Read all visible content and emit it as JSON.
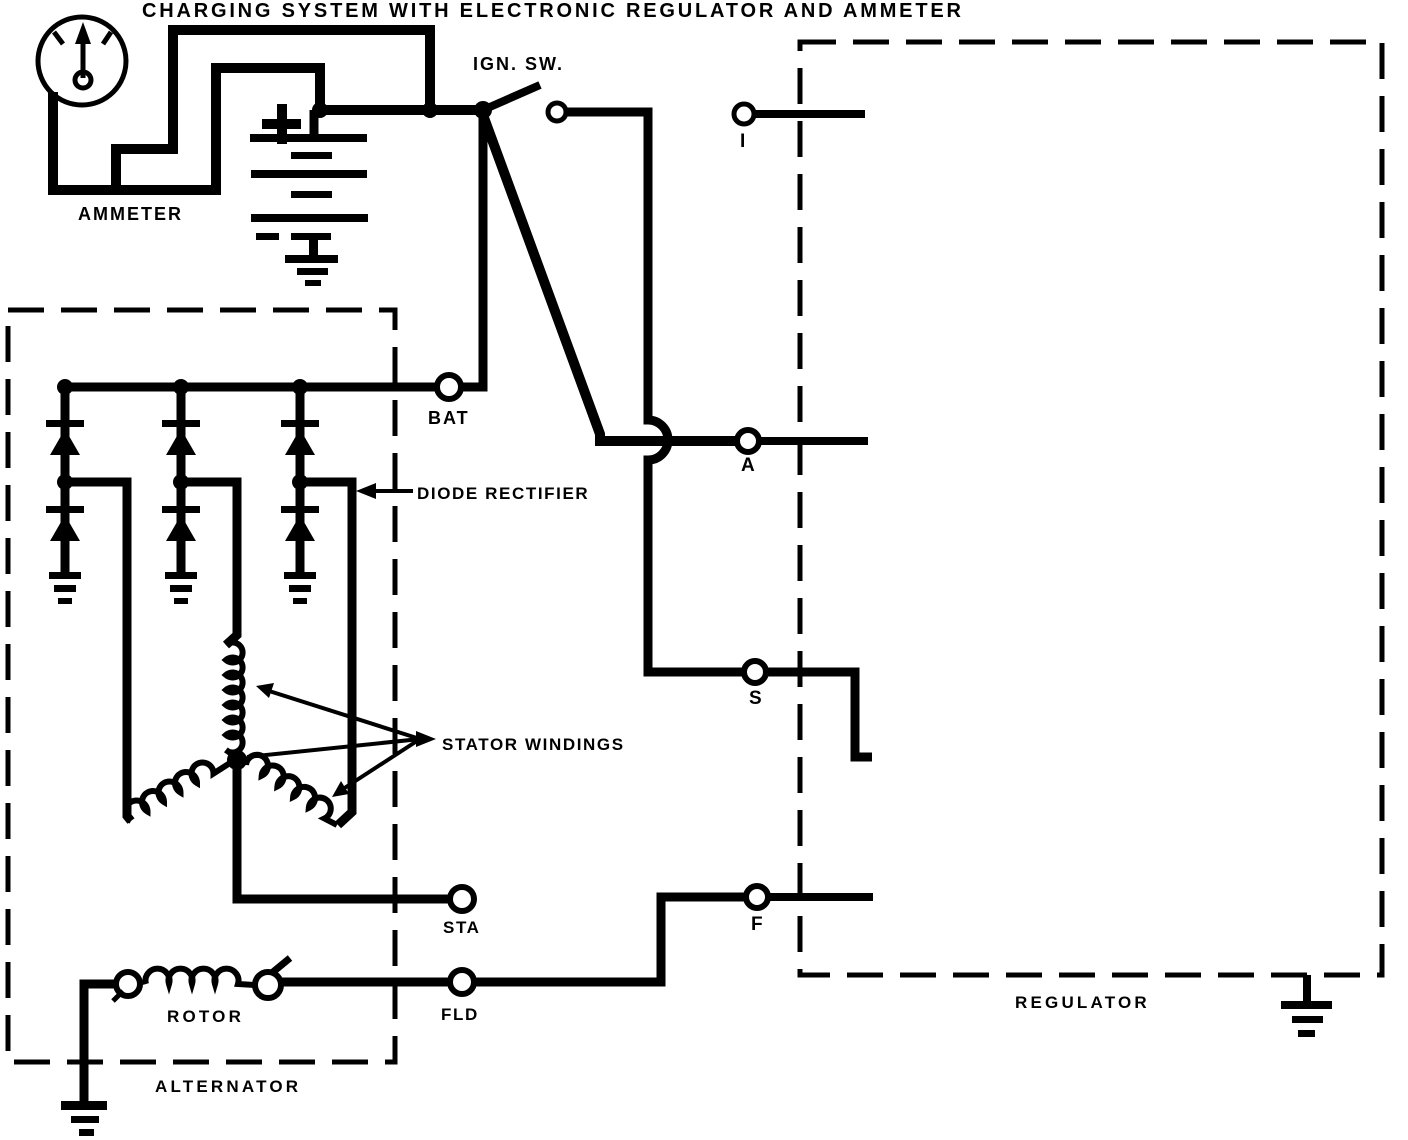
{
  "title": "CHARGING SYSTEM WITH ELECTRONIC REGULATOR AND AMMETER",
  "colors": {
    "ink": "#000000",
    "paper": "#ffffff"
  },
  "labels": {
    "ammeter": "AMMETER",
    "ign_sw": "IGN. SW.",
    "bat": "BAT",
    "diode_rectifier": "DIODE RECTIFIER",
    "stator_windings": "STATOR WINDINGS",
    "sta": "STA",
    "fld": "FLD",
    "rotor": "ROTOR",
    "alternator": "ALTERNATOR",
    "regulator": "REGULATOR",
    "terminal_i": "I",
    "terminal_a": "A",
    "terminal_s": "S",
    "terminal_f": "F"
  }
}
